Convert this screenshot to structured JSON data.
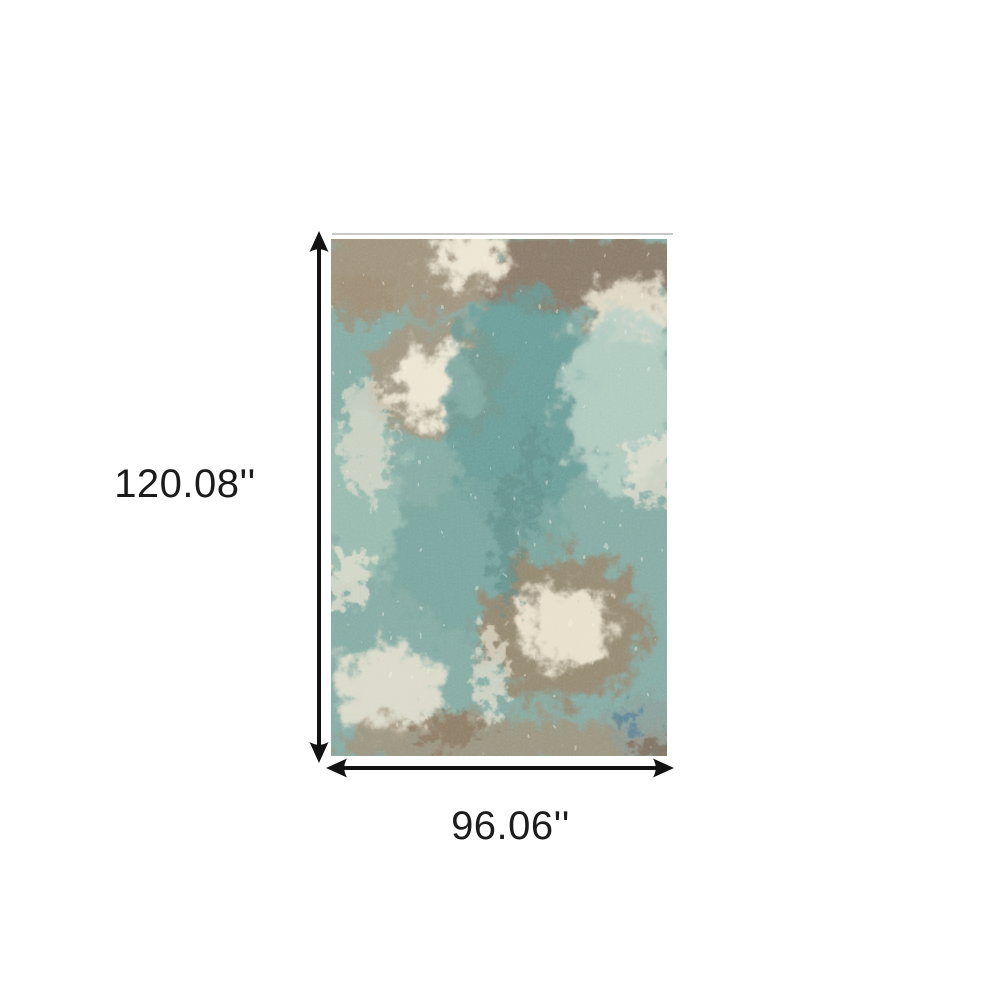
{
  "figure": {
    "height_label": "120.08''",
    "width_label": "96.06''",
    "arrow_color": "#121212",
    "label_color": "#1b1b1b",
    "background_color": "#ffffff",
    "rug_top_edge_color": "#c8c8c8",
    "rug_palette": {
      "base_teal": "#86aca4",
      "dark_teal": "#5d8b85",
      "seafoam": "#b7cfc4",
      "cream": "#ece5d3",
      "tan": "#a5947c",
      "brown": "#8a7866",
      "steel_blue": "#5a7f95"
    }
  }
}
